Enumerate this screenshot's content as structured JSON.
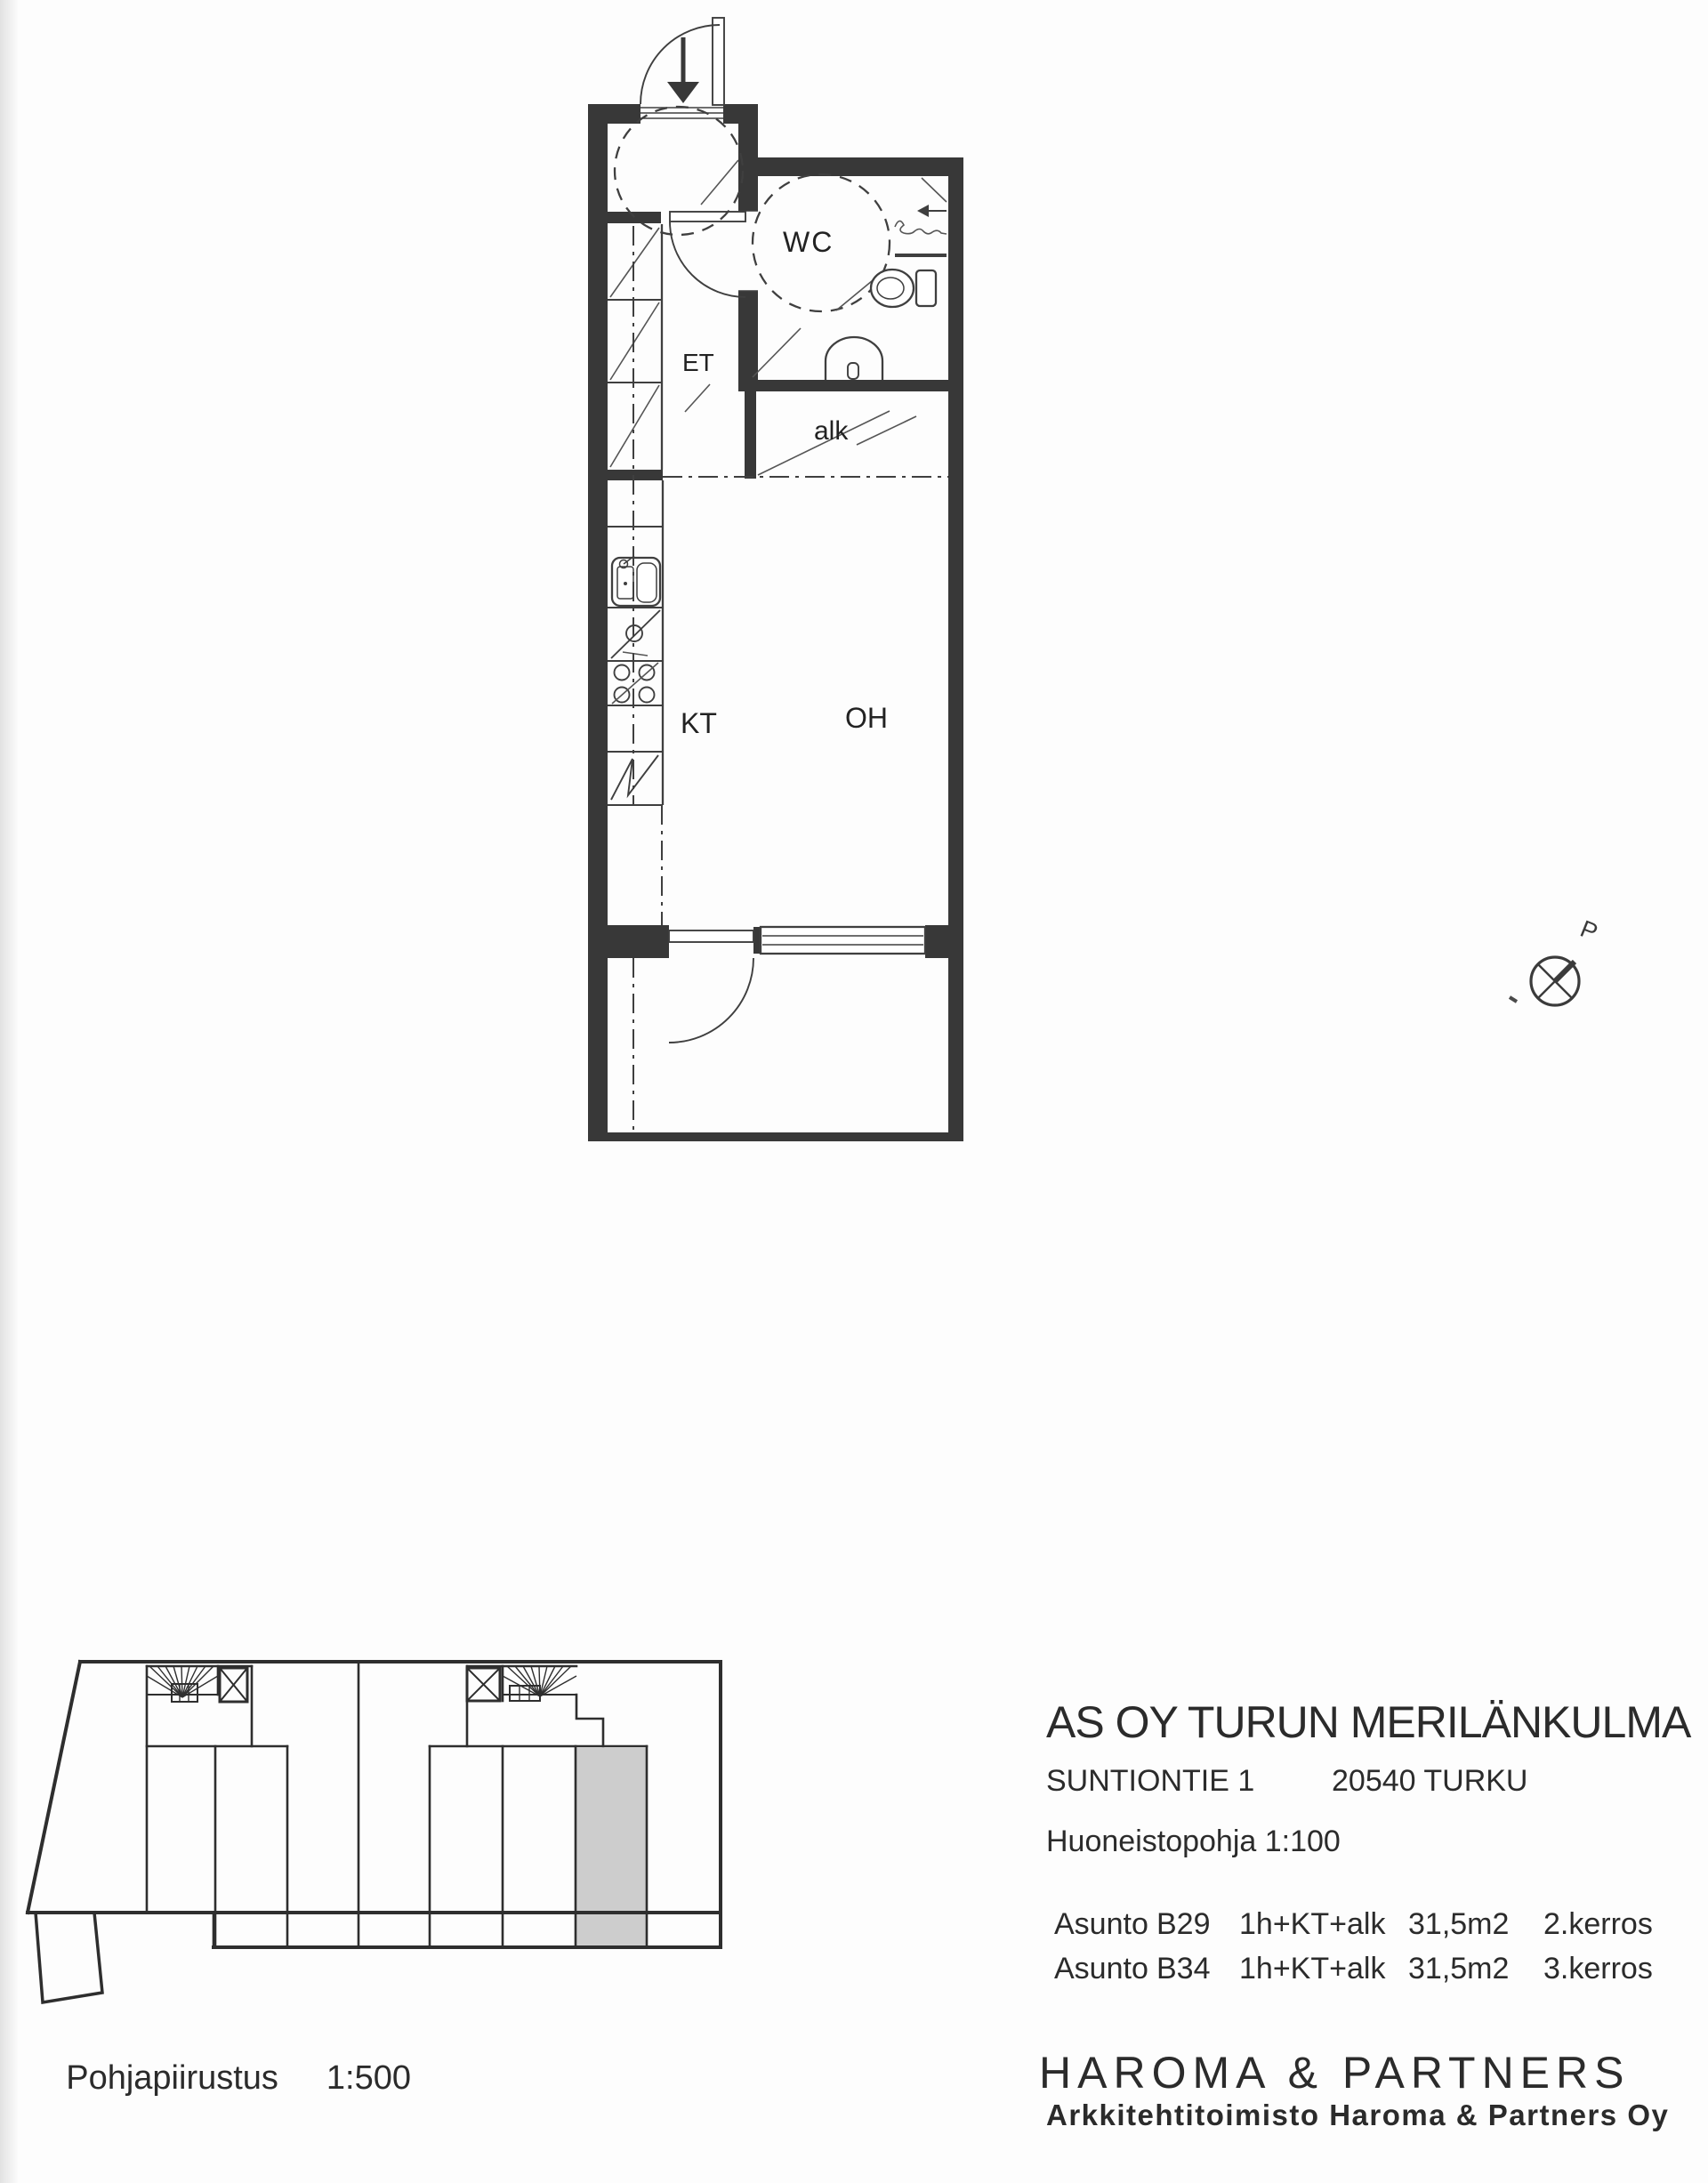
{
  "floor_plan": {
    "scale_note_implied_by": "Huoneistopohja 1:100",
    "rooms": {
      "et": "ET",
      "wc": "WC",
      "alk": "alk",
      "kt": "KT",
      "oh": "OH"
    },
    "compass_label": "P"
  },
  "site_plan": {
    "caption": "Pohjapiirustus",
    "scale": "1:500"
  },
  "title_block": {
    "project_name": "AS OY TURUN MERILÄNKULMA",
    "street": "SUNTIONTIE 1",
    "postal_city": "20540 TURKU",
    "plan_label": "Huoneistopohja 1:100",
    "apartments": [
      {
        "label": "Asunto",
        "id": "B29",
        "layout": "1h+KT+alk",
        "area": "31,5m2",
        "floor": "2.kerros"
      },
      {
        "label": "Asunto",
        "id": "B34",
        "layout": "1h+KT+alk",
        "area": "31,5m2",
        "floor": "3.kerros"
      }
    ],
    "firm": "HAROMA & PARTNERS",
    "firm_sub": "Arkkitehtitoimisto Haroma & Partners Oy"
  },
  "colors": {
    "wall": "#383838",
    "line": "#3f3f3f",
    "thin": "#555555",
    "highlight": "#cdcdcd",
    "text": "#2b2b2b"
  }
}
